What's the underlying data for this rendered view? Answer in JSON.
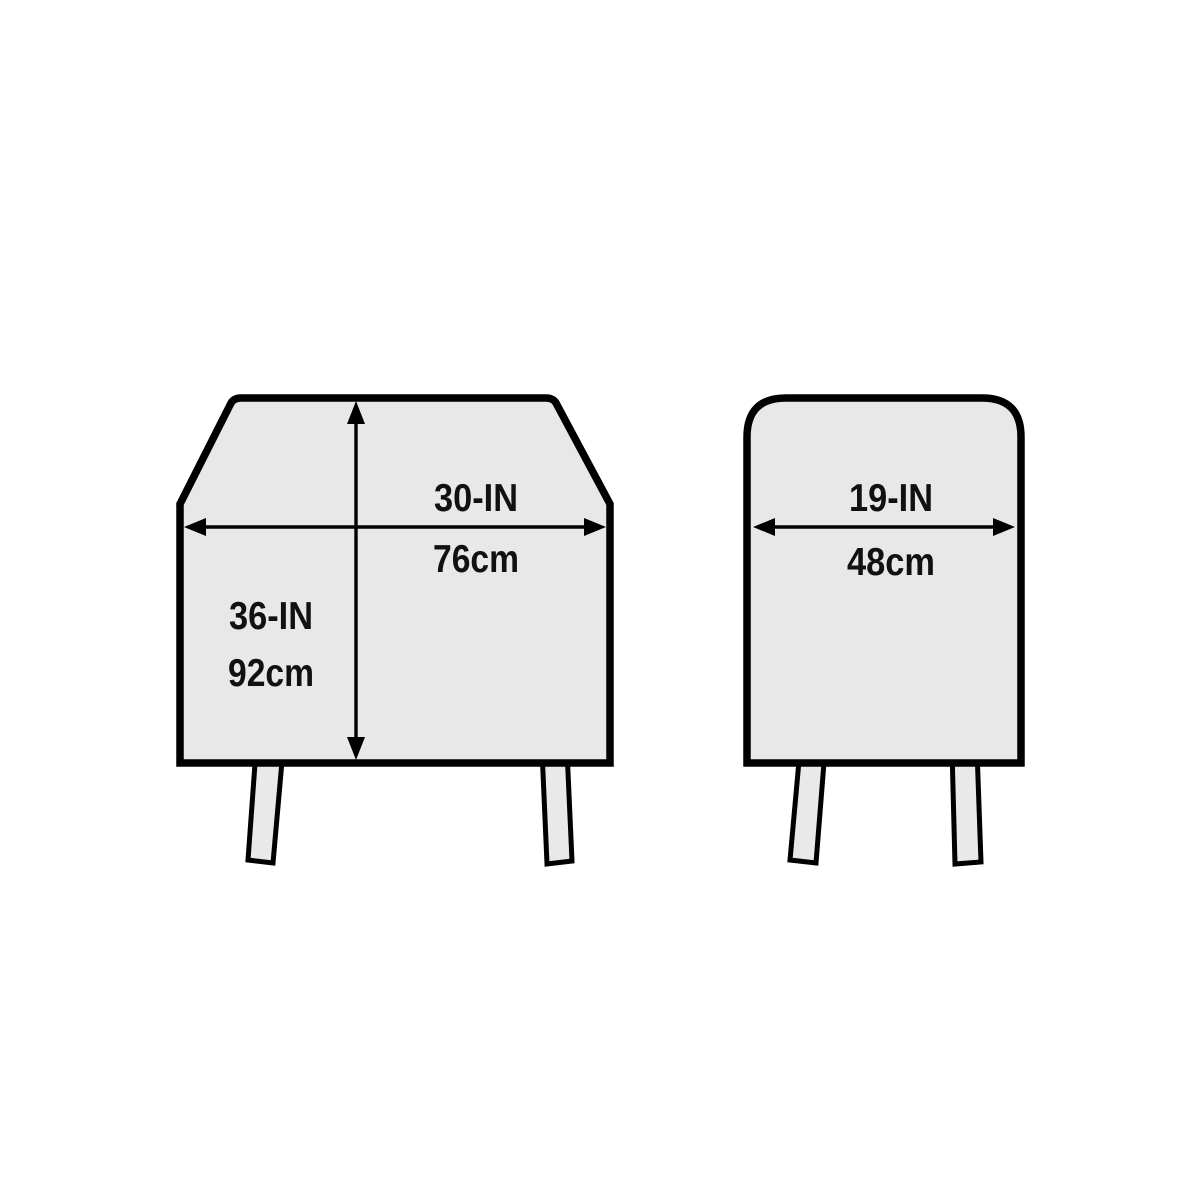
{
  "colors": {
    "background": "#ffffff",
    "outline": "#000000",
    "shape_fill": "#e8e8e8",
    "leg_fill": "#e9e9e9",
    "text": "#111111"
  },
  "front_view": {
    "width_in": "30-IN",
    "width_cm": "76cm",
    "height_in": "36-IN",
    "height_cm": "92cm"
  },
  "side_view": {
    "depth_in": "19-IN",
    "depth_cm": "48cm"
  }
}
